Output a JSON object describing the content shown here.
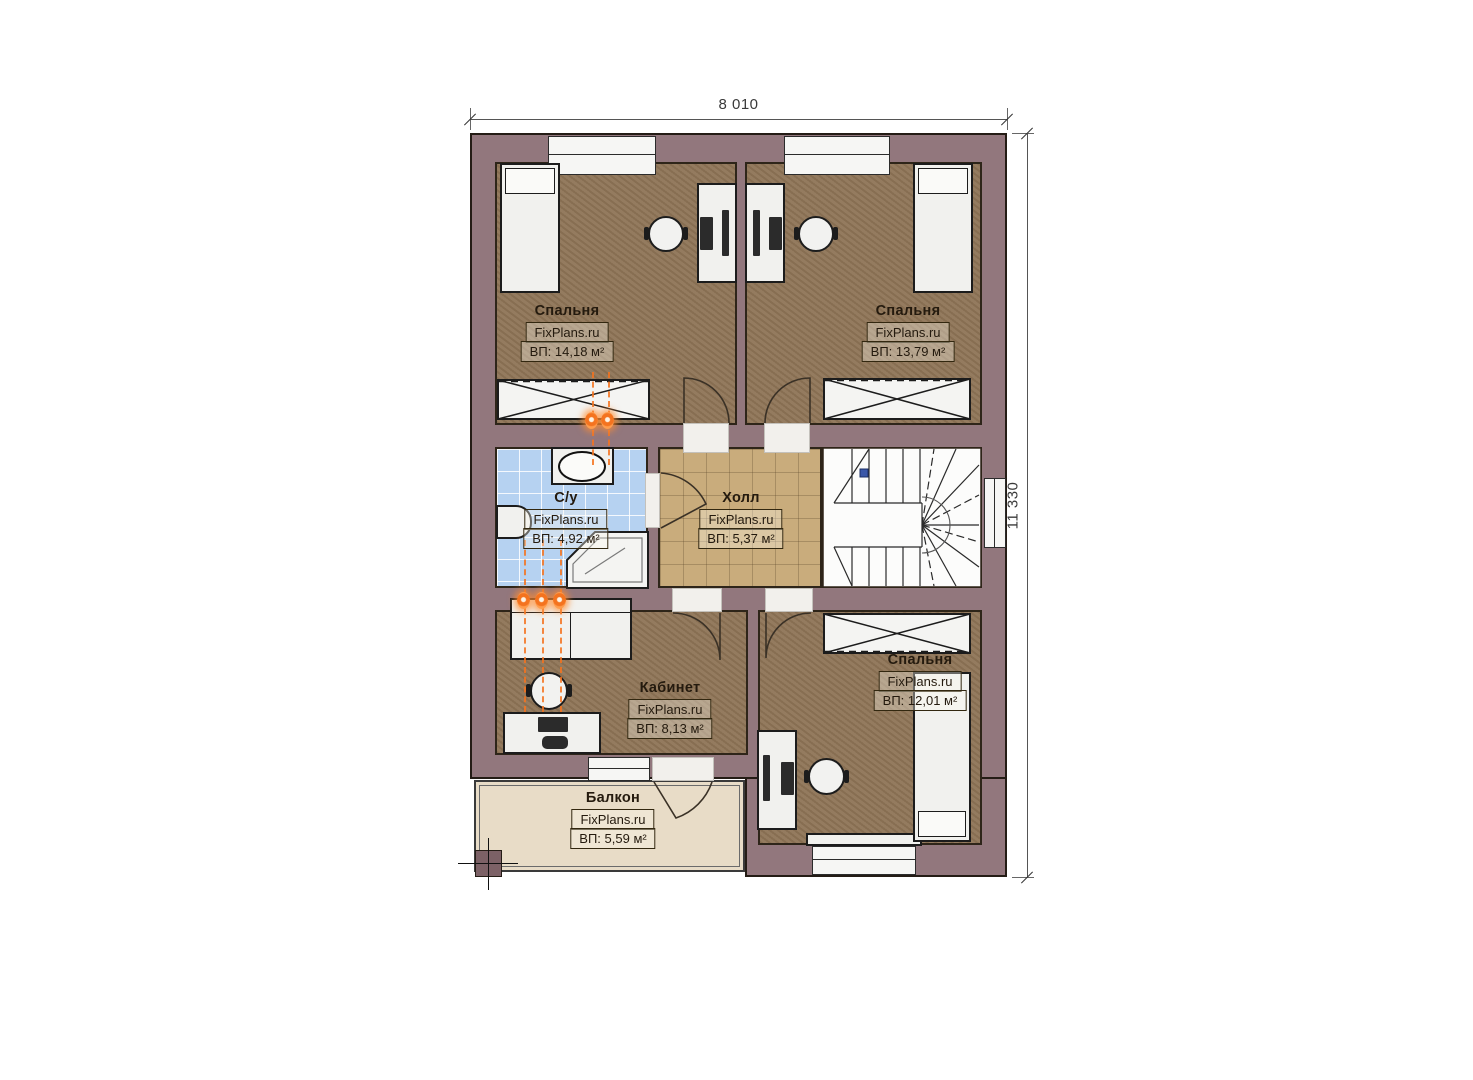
{
  "plan": {
    "watermark": "FixPlans.ru",
    "dimensions": {
      "width_label": "8 010",
      "height_label": "11 330"
    },
    "rooms": [
      {
        "id": "bedroom-top-left",
        "name": "Спальня",
        "area": "ВП: 14,18 м²"
      },
      {
        "id": "bedroom-top-right",
        "name": "Спальня",
        "area": "ВП: 13,79 м²"
      },
      {
        "id": "bathroom",
        "name": "С/у",
        "area": "ВП: 4,92 м²"
      },
      {
        "id": "hall",
        "name": "Холл",
        "area": "ВП: 5,37 м²"
      },
      {
        "id": "office",
        "name": "Кабинет",
        "area": "ВП: 8,13 м²"
      },
      {
        "id": "bedroom-bottom-right",
        "name": "Спальня",
        "area": "ВП: 12,01 м²"
      },
      {
        "id": "balcony",
        "name": "Балкон",
        "area": "ВП: 5,59 м²"
      }
    ],
    "colors": {
      "wall": "#92777D",
      "bedroom_floor": "#8E7457",
      "hall_floor": "#C9AC7C",
      "bathroom_floor": "#B6D2F1",
      "balcony_floor": "#E8DCC7",
      "riser_orange": "#F4731F",
      "stair_marker_blue": "#3A57A8"
    }
  }
}
